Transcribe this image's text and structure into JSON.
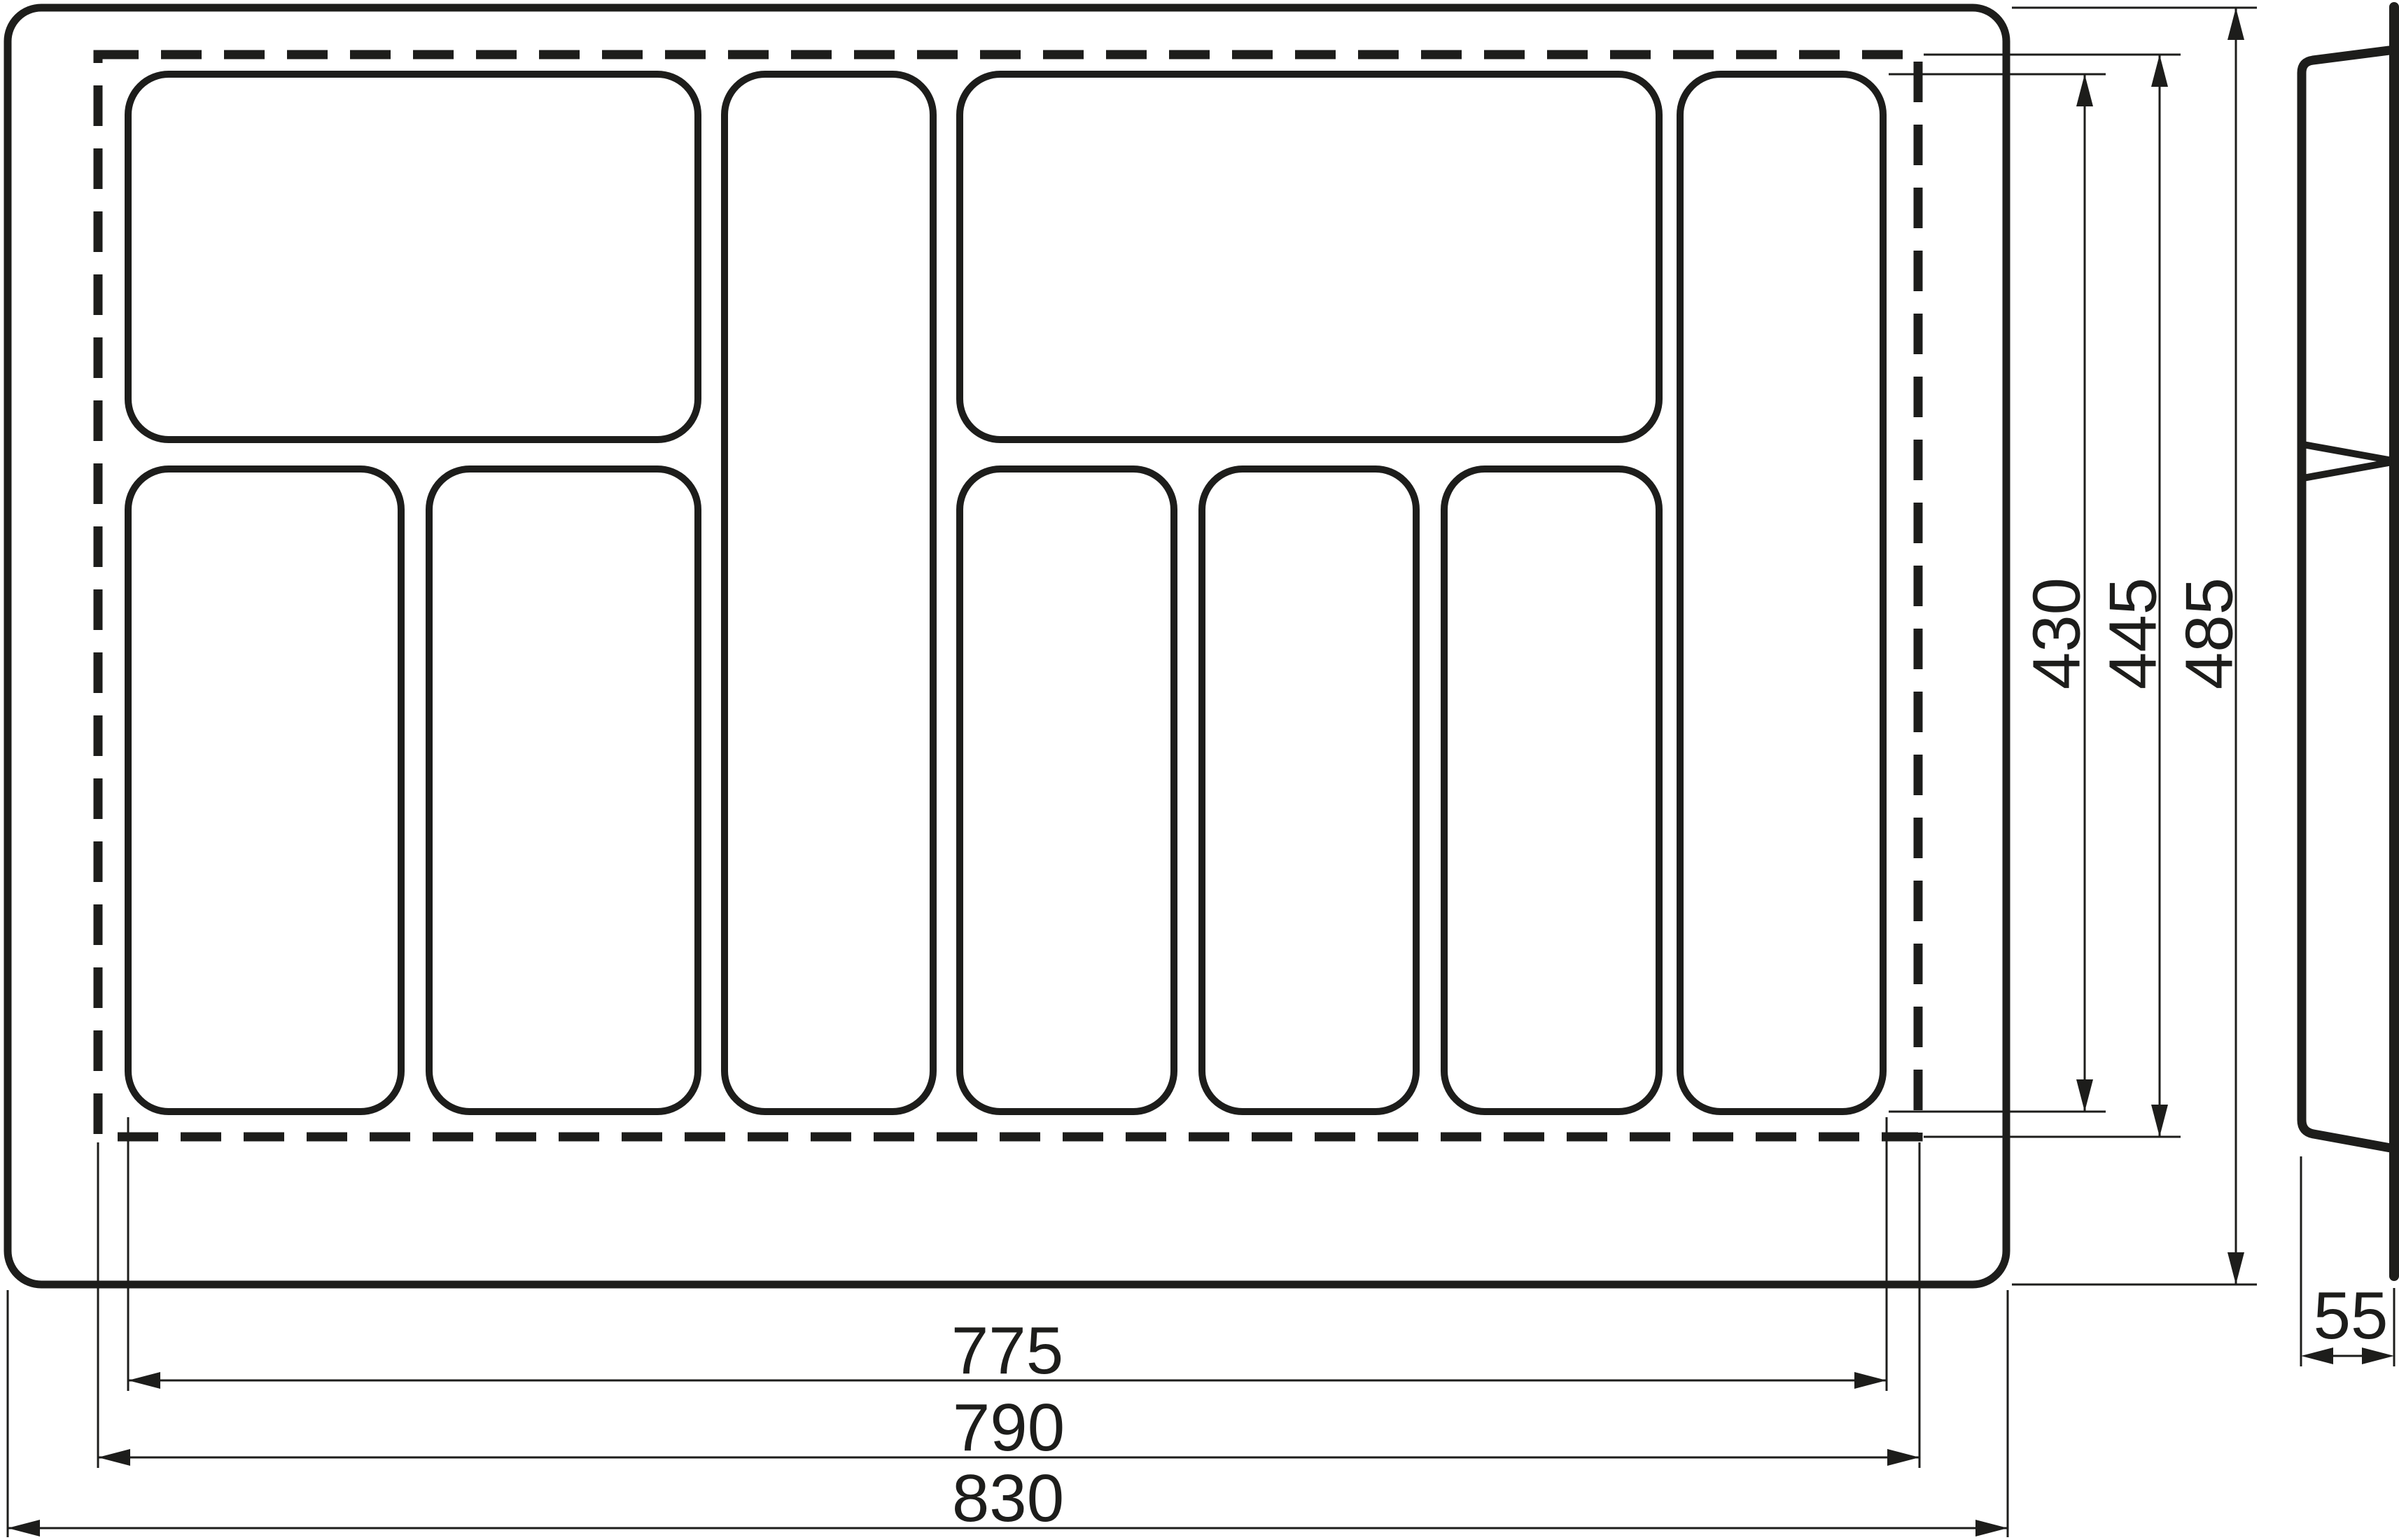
{
  "colors": {
    "ink": "#1d1d1b",
    "background": "#ffffff"
  },
  "front_view": {
    "compartment_count": 9
  },
  "dimensions": {
    "compartment_area_height": "430",
    "trim_height": "445",
    "overall_height": "485",
    "compartment_area_width": "775",
    "trim_width": "790",
    "overall_width": "830",
    "side_depth": "55"
  }
}
